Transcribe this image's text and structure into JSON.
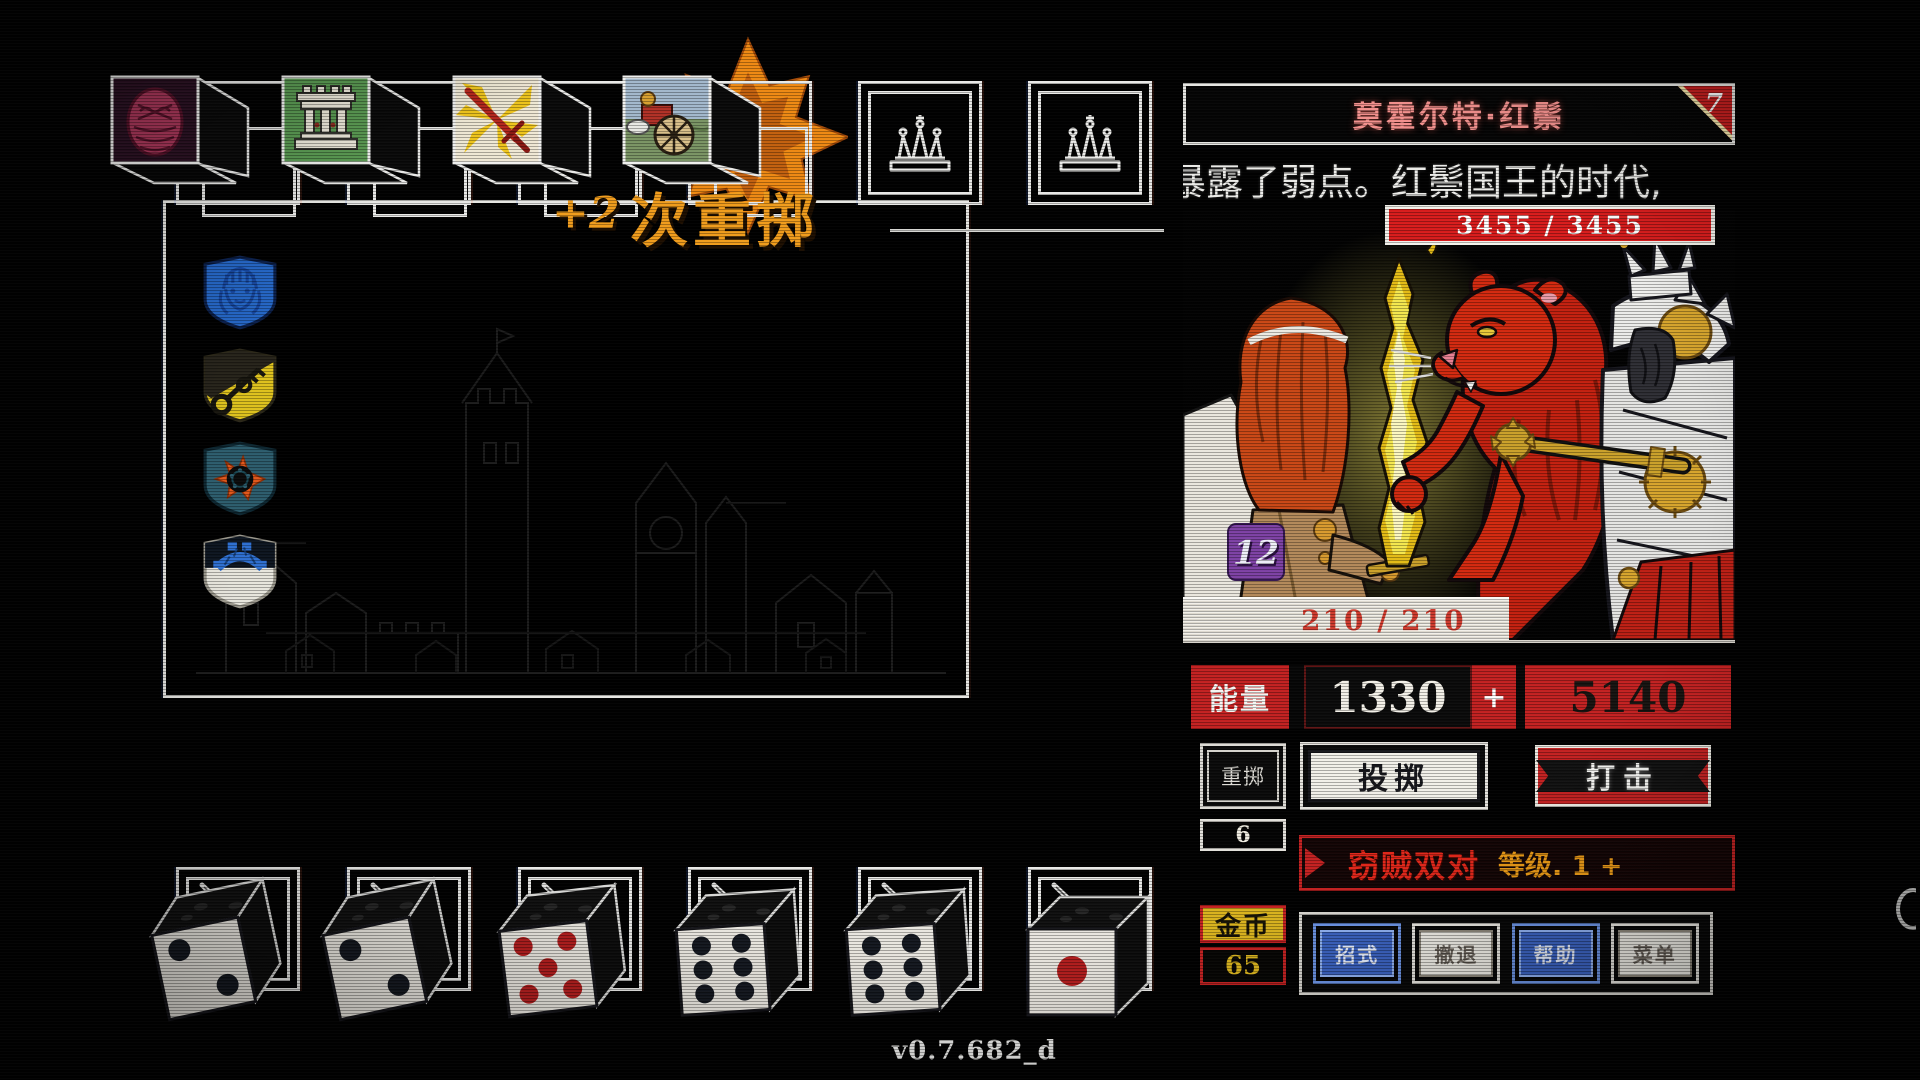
{
  "app": {
    "version_label": "v0.7.682_d"
  },
  "reroll_banner": {
    "bonus": "+2",
    "label": "次重掷"
  },
  "top_slots": [
    {
      "type": "die",
      "icon": "mask-die-face"
    },
    {
      "type": "die",
      "icon": "ruins-die-face"
    },
    {
      "type": "die",
      "icon": "sword-burst-die-face"
    },
    {
      "type": "die",
      "icon": "chariot-die-face",
      "highlighted": true
    },
    {
      "type": "empty",
      "icon": "crown-slot-icon"
    },
    {
      "type": "empty",
      "icon": "crown-slot-icon"
    }
  ],
  "crests": [
    {
      "name": "blue-maiden-crest"
    },
    {
      "name": "gold-key-crest"
    },
    {
      "name": "ember-wheel-crest"
    },
    {
      "name": "stone-bridge-crest"
    }
  ],
  "hand_dice": [
    {
      "value": 2,
      "pip_color": "black"
    },
    {
      "value": 2,
      "pip_color": "black"
    },
    {
      "value": 5,
      "pip_color": "red"
    },
    {
      "value": 6,
      "pip_color": "black"
    },
    {
      "value": 6,
      "pip_color": "black"
    },
    {
      "value": 1,
      "pip_color": "red"
    }
  ],
  "enemy_panel": {
    "name": "莫霍尔特·红鬃",
    "tier_badge": "7",
    "description": "暴露了弱点。红鬃国王的时代,",
    "enemy_hp": "3455 / 3455",
    "player_hp": "210 / 210",
    "shield_badge": "12",
    "energy_label": "能量",
    "energy_current": "1330",
    "energy_plus": "+",
    "energy_preview": "5140",
    "reroll_label": "重掷",
    "reroll_count": "6",
    "throw_label": "投掷",
    "strike_label": "打击",
    "combo_name": "窃贼双对",
    "combo_level": "等级. 1 +",
    "gold_label": "金币",
    "gold_amount": "65",
    "menu_buttons": [
      {
        "label": "招式",
        "style": "blue",
        "name": "moves-button"
      },
      {
        "label": "撤退",
        "style": "light",
        "name": "retreat-button"
      },
      {
        "label": "帮助",
        "style": "blue",
        "name": "help-button"
      },
      {
        "label": "菜单",
        "style": "light",
        "name": "menu-button"
      }
    ],
    "colors": {
      "hp_red": "#d81c1c",
      "energy_red": "#c32121",
      "gold": "#d9b31e",
      "badge_purple": "#7d41a4",
      "title_pink": "#f2908d",
      "combo_red": "#e02619",
      "combo_orange": "#ec9b16",
      "button_blue": "#3a62c0",
      "reroll_orange": "#f09c1c"
    }
  }
}
